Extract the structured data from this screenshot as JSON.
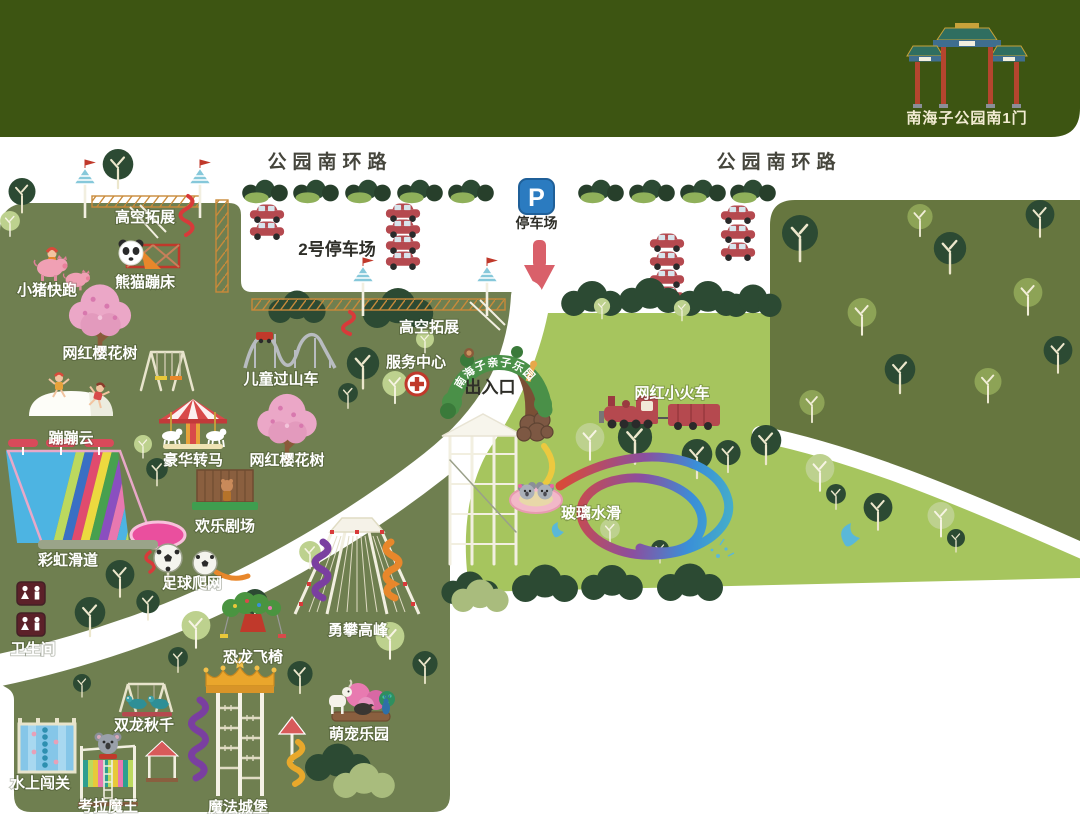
{
  "header": {
    "gate_label": "南海子公园南1门"
  },
  "roads": {
    "left": "公园南环路",
    "right": "公园南环路"
  },
  "parking": {
    "p": "P",
    "sign_label": "停车场",
    "lot2_label": "2号停车场"
  },
  "entrance": {
    "exit_label": "出入口",
    "arch_sign": "南海子亲子乐园",
    "service_center": "服务中心"
  },
  "facilities": {
    "restroom": "卫生间"
  },
  "attractions": {
    "rope_course_1": {
      "label": "高空拓展"
    },
    "rope_course_2": {
      "label": "高空拓展"
    },
    "pig_run": {
      "label": "小猪快跑"
    },
    "panda_trampoline": {
      "label": "熊猫蹦床"
    },
    "cherry_tree_1": {
      "label": "网红樱花树"
    },
    "cherry_tree_2": {
      "label": "网红樱花树"
    },
    "bouncing_cloud": {
      "label": "蹦蹦云"
    },
    "carousel": {
      "label": "豪华转马"
    },
    "kids_coaster": {
      "label": "儿童过山车"
    },
    "happy_theater": {
      "label": "欢乐剧场"
    },
    "rainbow_slide": {
      "label": "彩虹滑道"
    },
    "soccer_climb_net": {
      "label": "足球爬网"
    },
    "dino_flying_chair": {
      "label": "恐龙飞椅"
    },
    "double_dragon_swing": {
      "label": "双龙秋千"
    },
    "water_challenge": {
      "label": "水上闯关"
    },
    "koala_king": {
      "label": "考拉魔王"
    },
    "magic_castle": {
      "label": "魔法城堡"
    },
    "pet_paradise": {
      "label": "萌宠乐园"
    },
    "climb_peak": {
      "label": "勇攀高峰"
    },
    "train": {
      "label": "网红小火车"
    },
    "glass_water_slide": {
      "label": "玻璃水滑"
    }
  },
  "colors": {
    "header_green": "#3d5512",
    "map_olive": "#6f7f50",
    "forest_olive": "#66763f",
    "lawn_green": "#a6c55e",
    "path_white": "#ffffff",
    "parking_blue": "#2b7bc0",
    "car_red": "#b5494f",
    "arrow_red": "#d9606a"
  }
}
